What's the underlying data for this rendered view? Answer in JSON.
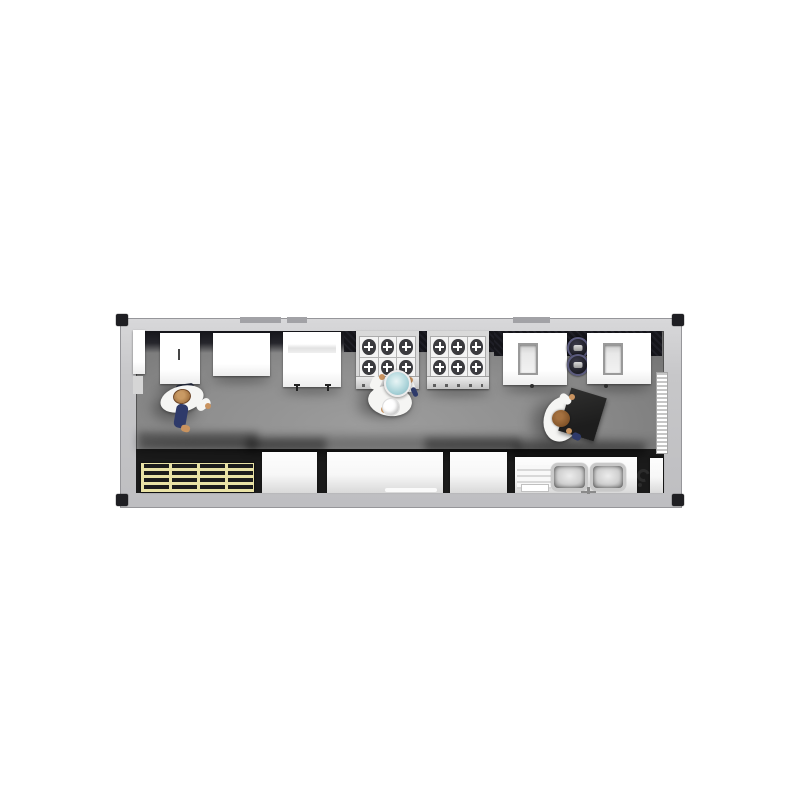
{
  "scene": {
    "type": "3d-floorplan-render",
    "view": "top-down",
    "subject": "shipping-container-commercial-kitchen"
  },
  "container": {
    "shell": "container-shell",
    "corner_fittings": 4,
    "roof_vents": 3
  },
  "equipment": {
    "door_left": "left-wall door panel",
    "refrigerator": "upright refrigerator",
    "worktable_1": "prep table",
    "worktable_shelf": "prep table with undershelf",
    "range_1": "6-burner gas range",
    "range_2": "6-burner gas range",
    "fryer_1": "fryer station",
    "stock_pots": "stacked stock pots",
    "fryer_2": "fryer station",
    "wall_rack": "wall-mounted rack",
    "pallet_rack": "slatted storage rack",
    "counter_1": "work counter",
    "counter_2": "long work counter",
    "counter_3": "work counter",
    "sink": "double-bowl sink with drainboard",
    "hose_reel": "hose reel / floor drain",
    "end_panel": "end wall panel"
  },
  "people": [
    {
      "id": "chef-left",
      "uniform": "white shirt, navy pants",
      "activity": "walking near refrigerator"
    },
    {
      "id": "chef-center",
      "uniform": "chef whites with toque",
      "activity": "holding pot at range"
    },
    {
      "id": "chef-right",
      "uniform": "chef whites",
      "activity": "carrying black tray"
    }
  ],
  "colors": {
    "page_bg": "#ffffff",
    "wall_gray": "#c7c7c9",
    "wall_edge": "#96969a",
    "casting_black": "#1f1f23",
    "floor_gray": "#8e8e8e",
    "band_dark": "#15151a",
    "equipment_white": "#ffffff",
    "steel_light": "#d9d9d9",
    "burner_dark": "#3b3b3f",
    "rack_yellow": "#e9e2a5",
    "rack_dark": "#1c1c1c",
    "pot_rim_blue": "#5b5b7e",
    "pot_lid_teal": "#a9d2d8",
    "tray_black": "#1d1d1d",
    "uniform_white": "#f5f5f3",
    "pants_navy": "#2e3a6a",
    "skin_tan": "#c9935f",
    "hair_brown": "#7d5026"
  }
}
